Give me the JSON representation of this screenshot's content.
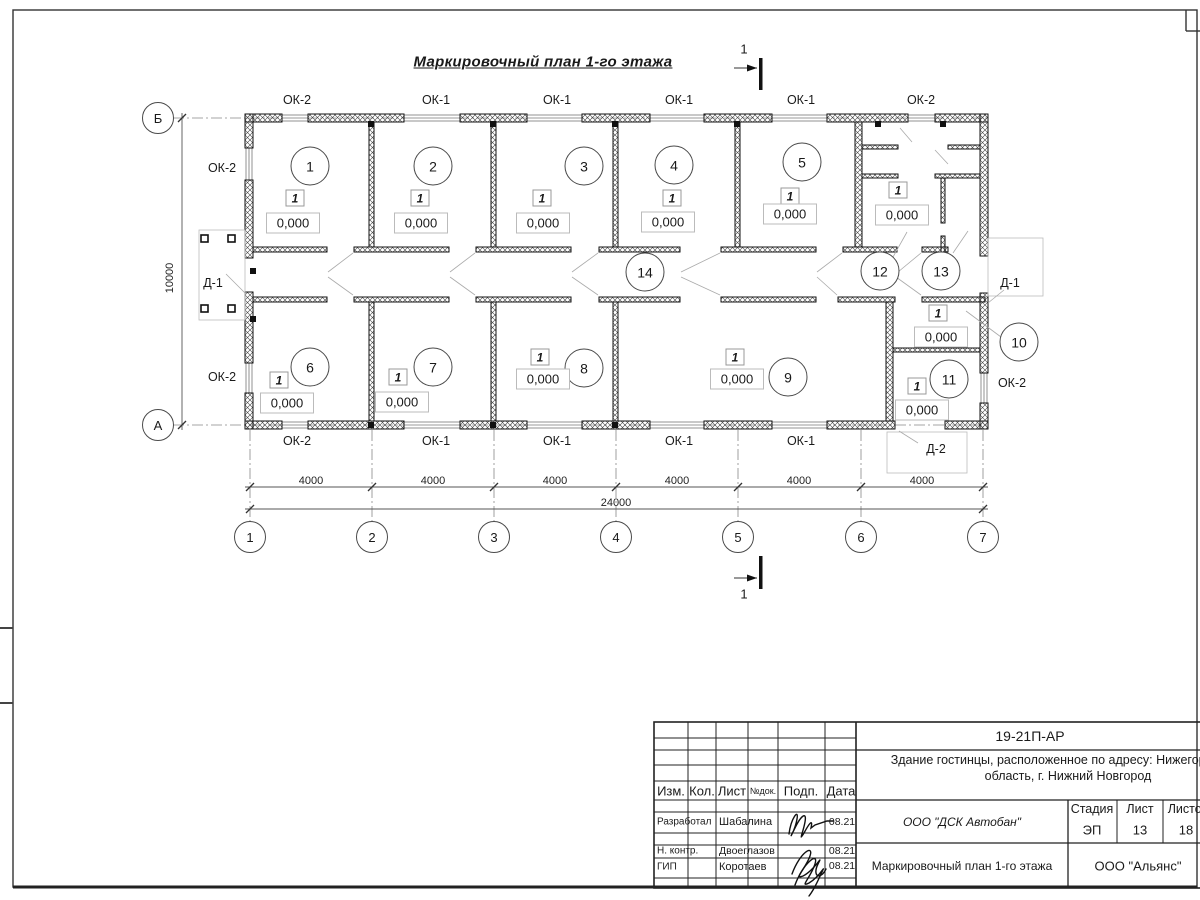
{
  "title": "Маркировочный план 1-го этажа",
  "plan": {
    "rooms": [
      {
        "n": "1",
        "x": 310,
        "y": 166
      },
      {
        "n": "2",
        "x": 433,
        "y": 166
      },
      {
        "n": "3",
        "x": 584,
        "y": 166
      },
      {
        "n": "4",
        "x": 674,
        "y": 165
      },
      {
        "n": "5",
        "x": 802,
        "y": 162
      },
      {
        "n": "6",
        "x": 310,
        "y": 367
      },
      {
        "n": "7",
        "x": 433,
        "y": 367
      },
      {
        "n": "8",
        "x": 584,
        "y": 368
      },
      {
        "n": "9",
        "x": 788,
        "y": 377
      },
      {
        "n": "10",
        "x": 1019,
        "y": 342
      },
      {
        "n": "11",
        "x": 949,
        "y": 379
      },
      {
        "n": "12",
        "x": 880,
        "y": 271
      },
      {
        "n": "13",
        "x": 941,
        "y": 271
      },
      {
        "n": "14",
        "x": 645,
        "y": 272
      }
    ],
    "unit_marks": [
      {
        "text": "1",
        "x": 295,
        "y": 198
      },
      {
        "text": "1",
        "x": 420,
        "y": 198
      },
      {
        "text": "1",
        "x": 542,
        "y": 198
      },
      {
        "text": "1",
        "x": 672,
        "y": 198
      },
      {
        "text": "1",
        "x": 790,
        "y": 196
      },
      {
        "text": "1",
        "x": 898,
        "y": 190
      },
      {
        "text": "1",
        "x": 279,
        "y": 380
      },
      {
        "text": "1",
        "x": 398,
        "y": 377
      },
      {
        "text": "1",
        "x": 540,
        "y": 357
      },
      {
        "text": "1",
        "x": 735,
        "y": 357
      },
      {
        "text": "1",
        "x": 938,
        "y": 313
      },
      {
        "text": "1",
        "x": 917,
        "y": 386
      }
    ],
    "elevations": [
      {
        "text": "0,000",
        "x": 293,
        "y": 223
      },
      {
        "text": "0,000",
        "x": 421,
        "y": 223
      },
      {
        "text": "0,000",
        "x": 543,
        "y": 223
      },
      {
        "text": "0,000",
        "x": 668,
        "y": 222
      },
      {
        "text": "0,000",
        "x": 790,
        "y": 214
      },
      {
        "text": "0,000",
        "x": 902,
        "y": 215
      },
      {
        "text": "0,000",
        "x": 287,
        "y": 403
      },
      {
        "text": "0,000",
        "x": 402,
        "y": 402
      },
      {
        "text": "0,000",
        "x": 543,
        "y": 379
      },
      {
        "text": "0,000",
        "x": 737,
        "y": 379
      },
      {
        "text": "0,000",
        "x": 941,
        "y": 337
      },
      {
        "text": "0,000",
        "x": 922,
        "y": 410
      }
    ],
    "labels": [
      {
        "text": "ОК-2",
        "x": 297,
        "y": 100
      },
      {
        "text": "ОК-1",
        "x": 436,
        "y": 100
      },
      {
        "text": "ОК-1",
        "x": 557,
        "y": 100
      },
      {
        "text": "ОК-1",
        "x": 679,
        "y": 100
      },
      {
        "text": "ОК-1",
        "x": 801,
        "y": 100
      },
      {
        "text": "ОК-2",
        "x": 921,
        "y": 100
      },
      {
        "text": "ОК-2",
        "x": 222,
        "y": 168
      },
      {
        "text": "Д-1",
        "x": 213,
        "y": 283
      },
      {
        "text": "ОК-2",
        "x": 222,
        "y": 377
      },
      {
        "text": "Д-1",
        "x": 1010,
        "y": 283
      },
      {
        "text": "ОК-2",
        "x": 1012,
        "y": 383
      },
      {
        "text": "ОК-2",
        "x": 297,
        "y": 441
      },
      {
        "text": "ОК-1",
        "x": 436,
        "y": 441
      },
      {
        "text": "ОК-1",
        "x": 557,
        "y": 441
      },
      {
        "text": "ОК-1",
        "x": 679,
        "y": 441
      },
      {
        "text": "ОК-1",
        "x": 801,
        "y": 441
      },
      {
        "text": "Д-2",
        "x": 936,
        "y": 449
      }
    ],
    "dims": [
      {
        "text": "4000",
        "x": 311,
        "y": 481
      },
      {
        "text": "4000",
        "x": 433,
        "y": 481
      },
      {
        "text": "4000",
        "x": 555,
        "y": 481
      },
      {
        "text": "4000",
        "x": 677,
        "y": 481
      },
      {
        "text": "4000",
        "x": 799,
        "y": 481
      },
      {
        "text": "4000",
        "x": 922,
        "y": 481
      },
      {
        "text": "24000",
        "x": 616,
        "y": 503
      },
      {
        "text": "10000",
        "x": 170,
        "y": 278,
        "rot": true
      }
    ],
    "axes": [
      {
        "n": "1",
        "x": 250,
        "y": 537
      },
      {
        "n": "2",
        "x": 372,
        "y": 537
      },
      {
        "n": "3",
        "x": 494,
        "y": 537
      },
      {
        "n": "4",
        "x": 616,
        "y": 537
      },
      {
        "n": "5",
        "x": 738,
        "y": 537
      },
      {
        "n": "6",
        "x": 861,
        "y": 537
      },
      {
        "n": "7",
        "x": 983,
        "y": 537
      },
      {
        "n": "Б",
        "x": 158,
        "y": 118
      },
      {
        "n": "А",
        "x": 158,
        "y": 425
      }
    ],
    "sections": [
      {
        "text": "1",
        "x": 744,
        "y": 49
      },
      {
        "text": "1",
        "x": 744,
        "y": 594
      }
    ]
  },
  "titleblock": {
    "doc_code": "19-21П-АР",
    "object_name": "Здание гостинцы, расположенное по адресу: Нижегородская область, г. Нижний Новгород",
    "cols": {
      "izm": "Изм.",
      "kol": "Кол.",
      "list": "Лист",
      "ndoc": "№док.",
      "podp": "Подп.",
      "data": "Дата"
    },
    "rows": [
      {
        "role": "Разработал",
        "name": "Шабалина",
        "date": "08.21"
      },
      {
        "role": "Н. контр.",
        "name": "Двоеглазов",
        "date": "08.21"
      },
      {
        "role": "ГИП",
        "name": "Коротаев",
        "date": "08.21"
      }
    ],
    "company": "ООО \"ДСК Автобан\"",
    "stage": {
      "h1": "Стадия",
      "h2": "Лист",
      "h3": "Листов",
      "v1": "ЭП",
      "v2": "13",
      "v3": "18"
    },
    "sheet_name": "Маркировочный план 1-го этажа",
    "org": "ООО \"Альянс\""
  }
}
